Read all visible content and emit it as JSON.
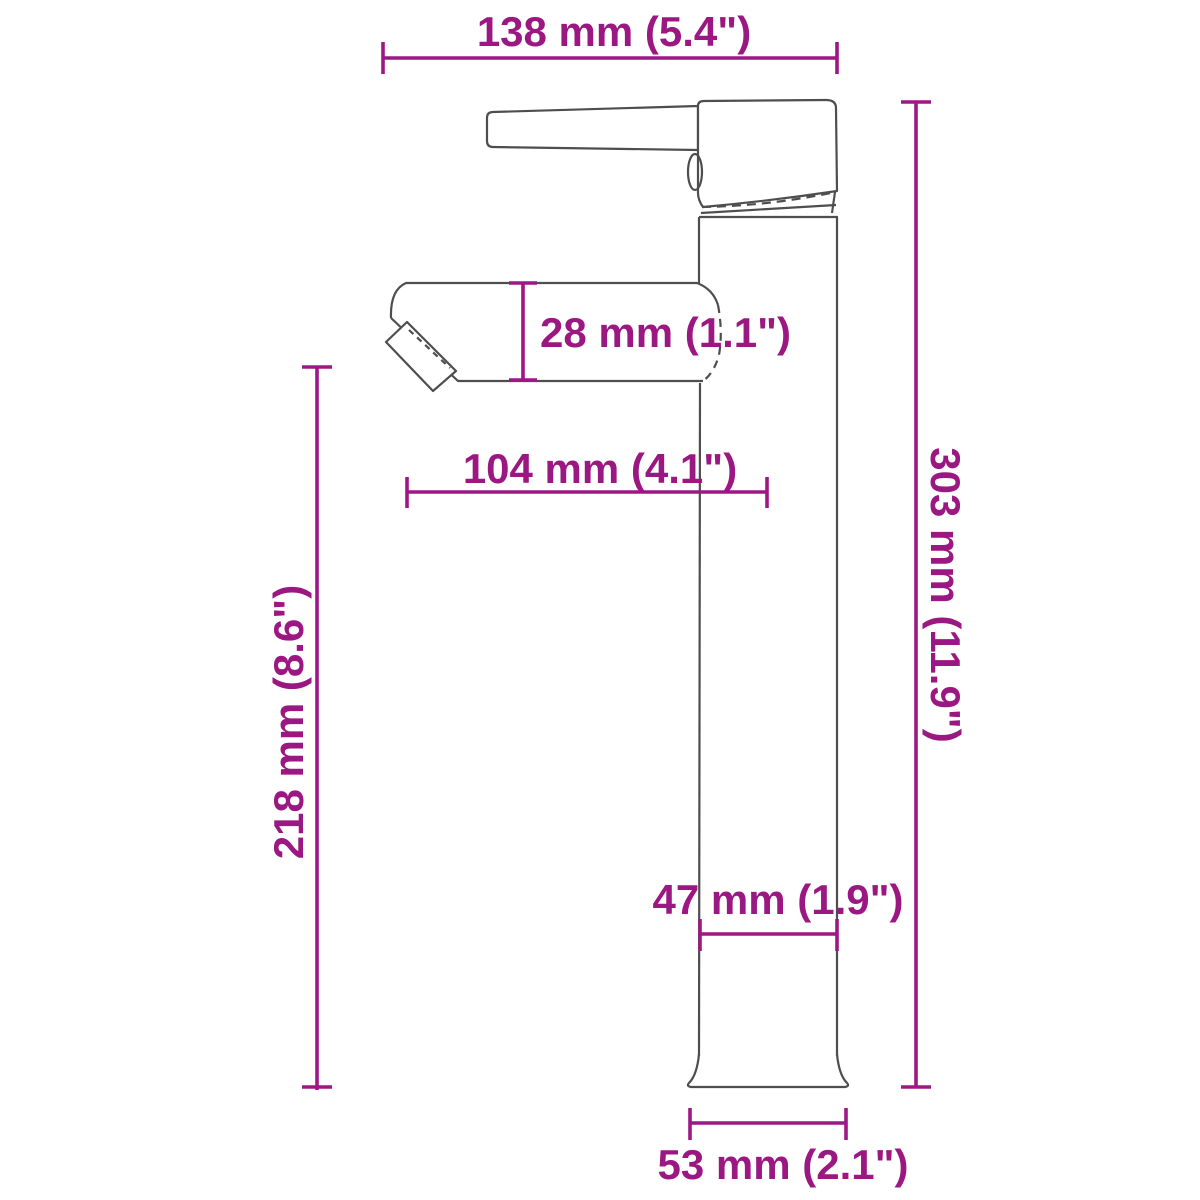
{
  "diagram": {
    "name": "faucet-dimension-diagram",
    "accent_color": "#9b1782",
    "outline_color": "#4e4e4e",
    "background_color": "#ffffff",
    "dimensions": {
      "top_width": "138 mm (5.4\")",
      "spout_height": "28 mm (1.1\")",
      "spout_reach": "104 mm (4.1\")",
      "total_height": "303 mm (11.9\")",
      "outlet_height": "218 mm (8.6\")",
      "body_width": "47 mm (1.9\")",
      "base_width": "53 mm (2.1\")"
    }
  }
}
